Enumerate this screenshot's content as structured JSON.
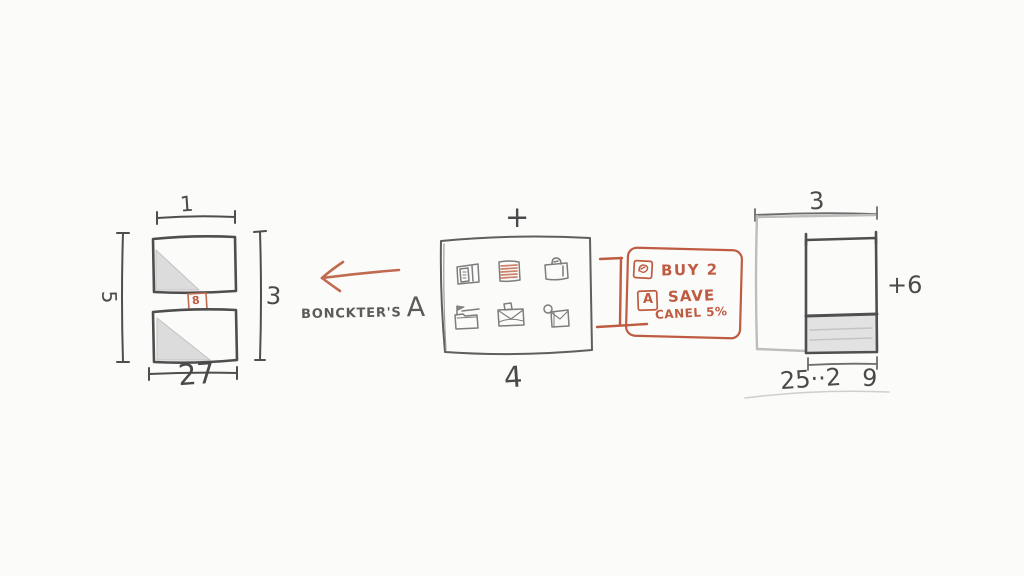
{
  "palette": {
    "paper": "#fbfbfa",
    "ink": "#4a4a4a",
    "light_ink": "#9a9a9a",
    "shade": "#d9d9d9",
    "accent": "#bf5b41"
  },
  "left_diagram": {
    "dim_top": "1",
    "dim_left": "5",
    "dim_right": "3",
    "dim_bottom": "27",
    "badge": "8"
  },
  "middle": {
    "caption": "BONCKTER'S",
    "caption_suffix": "A",
    "plus": "+",
    "dim_bottom": "4",
    "icons": [
      "book-icon",
      "notes-icon",
      "briefcase-icon",
      "folder-flag-icon",
      "inbox-icon",
      "bag-icon"
    ]
  },
  "annotation": {
    "line1": "BUY 2",
    "line2": "SAVE",
    "line3": "CANEL 5%",
    "badge": "A"
  },
  "right_diagram": {
    "dim_top": "3",
    "dim_right": "+6",
    "dim_bottom_left": "25··2",
    "dim_bottom_right": "9"
  }
}
